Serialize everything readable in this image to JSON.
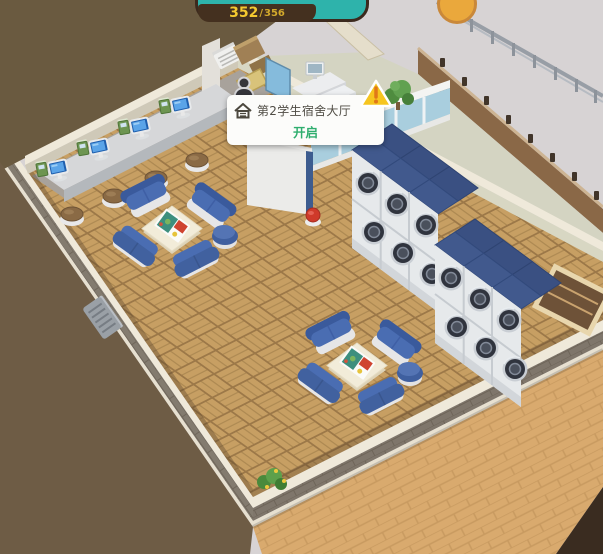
{
  "hud": {
    "counter": {
      "current": "352",
      "separator": "/",
      "max": "356"
    },
    "colors": {
      "bar_bg": "#44301f",
      "text": "#f4c930",
      "pill": "#2eb3ab",
      "badge": "#eaa83c"
    }
  },
  "tooltip": {
    "room_name": "第2学生宿舍大厅",
    "action_label": "开启",
    "icons": {
      "room": "house-icon",
      "warning": "warning-triangle-icon",
      "marker": "person-marker-icon"
    },
    "colors": {
      "action_text": "#2fae6e",
      "warning": "#f6c51f"
    }
  },
  "scene": {
    "objects": [
      "computer-counter",
      "desktop-computer x4",
      "arcade-box x4",
      "stool x4",
      "sofa-group x2",
      "board-game-table x2",
      "ottoman x2",
      "washing-machine-bank x2 (3x2 stacked)",
      "glass-partition",
      "partition-plant",
      "reception-desk",
      "printer",
      "cardboard-boxes",
      "monitor-desk",
      "drawer-cabinet",
      "red-stool",
      "corner-plant",
      "radiator",
      "wooden-bench",
      "terrace-railing"
    ],
    "palette": {
      "floor_wood": "#c79f63",
      "floor_grout": "#9c7848",
      "wall_trim": "#efe9da",
      "wall_face": "#d8d7c3",
      "sofa_blue": "#4a6db2",
      "washer_top_blue": "#41598d",
      "ground_brown": "#6e5c45",
      "path_tan": "#d9aa6e",
      "sky_gray": "#d7d3d4",
      "glass_blue": "#a9cede"
    }
  }
}
